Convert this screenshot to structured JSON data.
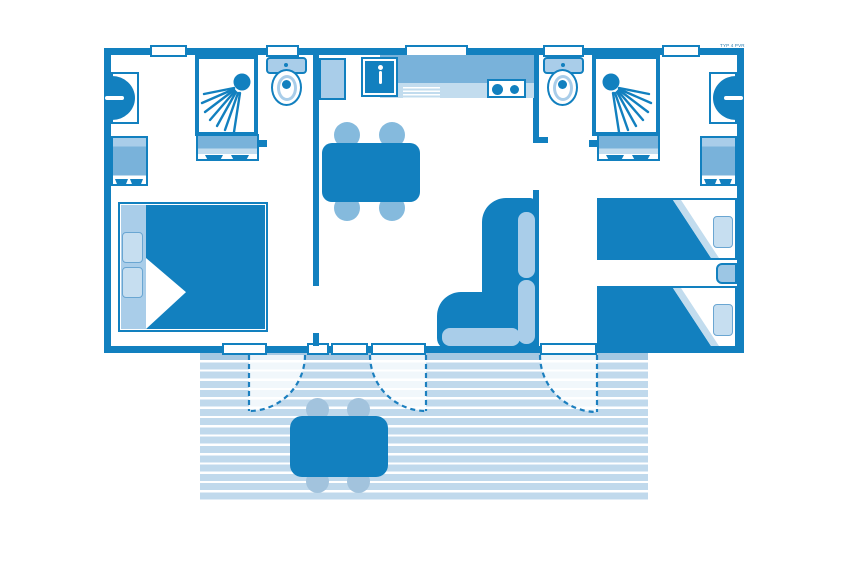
{
  "header": {
    "plan_code": "TYP 4 PVR"
  },
  "palette": {
    "wall_dark_blue": "#1280bf",
    "mid_blue": "#79b2da",
    "light_blue": "#a9cde9",
    "pale_blue": "#c2dcee",
    "terrace_deck": "#c0d9ec",
    "terrace_furniture": "#a2c3dd",
    "background": "#ffffff"
  },
  "plan": {
    "type": "mobile-home floor plan",
    "rooms": [
      "left-bedroom-double",
      "left-shower-room",
      "left-wc",
      "kitchen-living",
      "right-wc",
      "right-shower-room",
      "right-bedroom-twin",
      "terrace"
    ],
    "furniture": [
      "double-bed",
      "twin-bed",
      "twin-bed",
      "nightstand",
      "wardrobe",
      "wardrobe",
      "sofa-l-shaped",
      "dining-table-4-chairs",
      "terrace-table-4-chairs",
      "kitchen-sink",
      "hob-2-burners",
      "shower",
      "shower",
      "toilet",
      "toilet",
      "washbasin",
      "washbasin",
      "vanity-unit",
      "vanity-unit"
    ],
    "doors_to_terrace": 3,
    "windows_top": 5,
    "windows_bottom": 3
  }
}
